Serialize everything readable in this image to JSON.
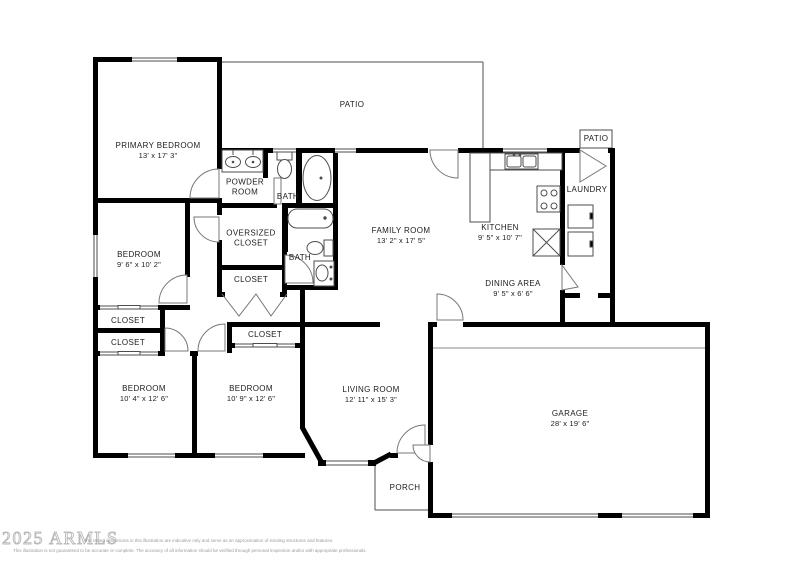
{
  "colors": {
    "wall": "#000000",
    "thin_line": "#4d4d4d",
    "door_arc": "#777777",
    "text": "#1c1c1c",
    "watermark": "#b9b9b9",
    "background": "#ffffff"
  },
  "watermark": {
    "text": "2025 ARMLS"
  },
  "disclaimer": {
    "line1": "the stated dimensions in this illustration are indicative only and serve as an approximation of existing structures and features.",
    "line2": "This illustration is not guaranteed to be accurate or complete. The accuracy of all information should be verified through personal inspection and/or with appropriate professionals."
  },
  "rooms": [
    {
      "id": "primary-bedroom",
      "name": "PRIMARY BEDROOM",
      "dims": "13' x 17' 3\"",
      "x": 158,
      "y": 151
    },
    {
      "id": "patio-top",
      "name": "PATIO",
      "dims": "",
      "x": 352,
      "y": 105
    },
    {
      "id": "powder-room",
      "name": "POWDER ROOM",
      "dims": "",
      "x": 245,
      "y": 188,
      "w": 50
    },
    {
      "id": "bath-primary",
      "name": "BATH",
      "dims": "",
      "x": 288,
      "y": 197
    },
    {
      "id": "oversized-closet",
      "name": "OVERSIZED CLOSET",
      "dims": "",
      "x": 251,
      "y": 239,
      "w": 64
    },
    {
      "id": "bath-hall",
      "name": "BATH",
      "dims": "",
      "x": 300,
      "y": 258
    },
    {
      "id": "closet-center",
      "name": "CLOSET",
      "dims": "",
      "x": 251,
      "y": 280
    },
    {
      "id": "family-room",
      "name": "FAMILY ROOM",
      "dims": "13' 2\" x 17' 5\"",
      "x": 401,
      "y": 236
    },
    {
      "id": "kitchen",
      "name": "KITCHEN",
      "dims": "9' 5\" x 10' 7\"",
      "x": 500,
      "y": 233
    },
    {
      "id": "laundry",
      "name": "LAUNDRY",
      "dims": "",
      "x": 587,
      "y": 190
    },
    {
      "id": "patio-right",
      "name": "PATIO",
      "dims": "",
      "x": 596,
      "y": 139
    },
    {
      "id": "dining-area",
      "name": "DINING AREA",
      "dims": "9' 5\" x 6' 6\"",
      "x": 513,
      "y": 289
    },
    {
      "id": "bedroom-left",
      "name": "BEDROOM",
      "dims": "9' 6\" x 10' 2\"",
      "x": 139,
      "y": 260
    },
    {
      "id": "closet-a",
      "name": "CLOSET",
      "dims": "",
      "x": 128,
      "y": 321
    },
    {
      "id": "closet-b",
      "name": "CLOSET",
      "dims": "",
      "x": 128,
      "y": 343
    },
    {
      "id": "closet-right",
      "name": "CLOSET",
      "dims": "",
      "x": 265,
      "y": 335
    },
    {
      "id": "bedroom-bottom-left",
      "name": "BEDROOM",
      "dims": "10' 4\" x 12' 6\"",
      "x": 144,
      "y": 394
    },
    {
      "id": "bedroom-bottom-mid",
      "name": "BEDROOM",
      "dims": "10' 9\" x 12' 6\"",
      "x": 251,
      "y": 394
    },
    {
      "id": "living-room",
      "name": "LIVING ROOM",
      "dims": "12' 11\" x 15' 3\"",
      "x": 371,
      "y": 395
    },
    {
      "id": "garage",
      "name": "GARAGE",
      "dims": "28' x 19' 6\"",
      "x": 570,
      "y": 419
    },
    {
      "id": "porch",
      "name": "PORCH",
      "dims": "",
      "x": 405,
      "y": 488
    }
  ]
}
